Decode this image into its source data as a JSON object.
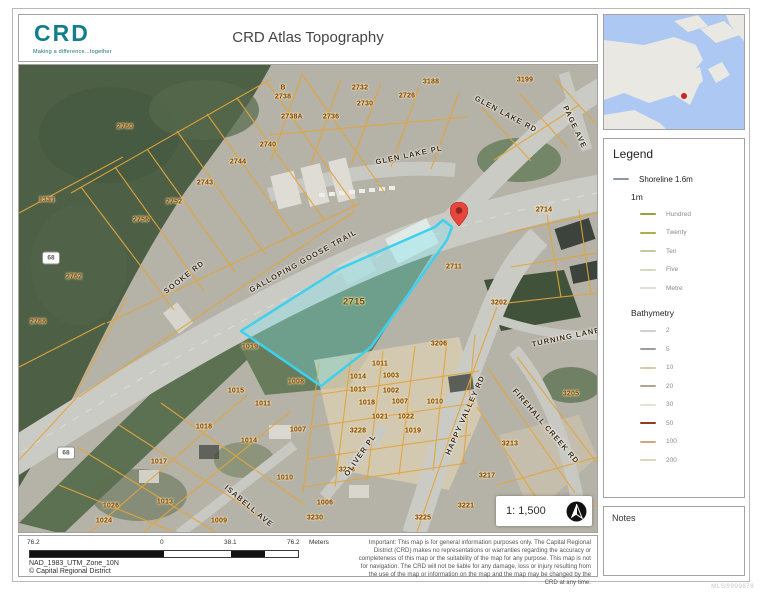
{
  "header": {
    "logo_text": "CRD",
    "logo_tagline": "Making a difference...together",
    "title": "CRD Atlas Topography"
  },
  "overview_map": {
    "water_color": "#adc8f2",
    "land_color": "#e9e8e2",
    "marker_color": "#cc2420"
  },
  "legend": {
    "title": "Legend",
    "shoreline": {
      "label": "Shoreline 1.6m",
      "color": "#8b9aa8"
    },
    "group_1m": {
      "label": "1m",
      "items": [
        {
          "label": "Hundred",
          "color": "#97a23a"
        },
        {
          "label": "Twenty",
          "color": "#a9b14b"
        },
        {
          "label": "Ten",
          "color": "#c6c8a0"
        },
        {
          "label": "Five",
          "color": "#d6d8bf"
        },
        {
          "label": "Metre",
          "color": "#e2e3d5"
        }
      ]
    },
    "group_bathymetry": {
      "label": "Bathymetry",
      "items": [
        {
          "label": "2",
          "color": "#cfcfcf"
        },
        {
          "label": "5",
          "color": "#9d9d9d"
        },
        {
          "label": "10",
          "color": "#d9c9a7"
        },
        {
          "label": "20",
          "color": "#b3a18b"
        },
        {
          "label": "30",
          "color": "#e4e0d2"
        },
        {
          "label": "50",
          "color": "#8e3b25"
        },
        {
          "label": "100",
          "color": "#d6a878"
        },
        {
          "label": "200",
          "color": "#e3d3b8"
        }
      ]
    }
  },
  "notes": {
    "title": "Notes"
  },
  "map": {
    "scale_text": "1: 1,500",
    "highlight_parcel": "2715",
    "parcel_line_color": "#e2a43c",
    "highlight_color": "#3ed0ee",
    "parcel_labels": [
      {
        "text": "2760",
        "x": 106,
        "y": 62
      },
      {
        "text": "1331",
        "x": 28,
        "y": 135
      },
      {
        "text": "2762",
        "x": 55,
        "y": 212
      },
      {
        "text": "2768",
        "x": 19,
        "y": 257
      },
      {
        "text": "2756",
        "x": 122,
        "y": 155
      },
      {
        "text": "2752",
        "x": 155,
        "y": 137
      },
      {
        "text": "2743",
        "x": 186,
        "y": 118
      },
      {
        "text": "2744",
        "x": 219,
        "y": 97
      },
      {
        "text": "2740",
        "x": 249,
        "y": 80
      },
      {
        "text": "B",
        "x": 264,
        "y": 23
      },
      {
        "text": "2738",
        "x": 264,
        "y": 32
      },
      {
        "text": "2738A",
        "x": 273,
        "y": 52
      },
      {
        "text": "2736",
        "x": 312,
        "y": 52
      },
      {
        "text": "2732",
        "x": 341,
        "y": 23
      },
      {
        "text": "2730",
        "x": 346,
        "y": 39
      },
      {
        "text": "2726",
        "x": 388,
        "y": 31
      },
      {
        "text": "3188",
        "x": 412,
        "y": 17
      },
      {
        "text": "3199",
        "x": 506,
        "y": 15
      },
      {
        "text": "2714",
        "x": 525,
        "y": 145
      },
      {
        "text": "2711",
        "x": 435,
        "y": 202
      },
      {
        "text": "2715",
        "x": 335,
        "y": 237,
        "big": true
      },
      {
        "text": "3202",
        "x": 480,
        "y": 238
      },
      {
        "text": "3206",
        "x": 420,
        "y": 279
      },
      {
        "text": "1019",
        "x": 231,
        "y": 282
      },
      {
        "text": "1008",
        "x": 277,
        "y": 317
      },
      {
        "text": "1011",
        "x": 361,
        "y": 299
      },
      {
        "text": "1015",
        "x": 217,
        "y": 326
      },
      {
        "text": "1011",
        "x": 244,
        "y": 339
      },
      {
        "text": "1014",
        "x": 339,
        "y": 312
      },
      {
        "text": "1003",
        "x": 372,
        "y": 311
      },
      {
        "text": "1013",
        "x": 339,
        "y": 325
      },
      {
        "text": "1002",
        "x": 372,
        "y": 326
      },
      {
        "text": "1018",
        "x": 348,
        "y": 338
      },
      {
        "text": "1007",
        "x": 381,
        "y": 337
      },
      {
        "text": "1010",
        "x": 416,
        "y": 337
      },
      {
        "text": "1021",
        "x": 361,
        "y": 352
      },
      {
        "text": "1022",
        "x": 387,
        "y": 352
      },
      {
        "text": "3228",
        "x": 339,
        "y": 366
      },
      {
        "text": "1019",
        "x": 394,
        "y": 366
      },
      {
        "text": "1007",
        "x": 279,
        "y": 365
      },
      {
        "text": "1014",
        "x": 230,
        "y": 376
      },
      {
        "text": "3226",
        "x": 328,
        "y": 405
      },
      {
        "text": "1010",
        "x": 266,
        "y": 413
      },
      {
        "text": "1006",
        "x": 306,
        "y": 438
      },
      {
        "text": "3230",
        "x": 296,
        "y": 453
      },
      {
        "text": "1018",
        "x": 185,
        "y": 362
      },
      {
        "text": "1017",
        "x": 140,
        "y": 397
      },
      {
        "text": "1026",
        "x": 92,
        "y": 441
      },
      {
        "text": "1024",
        "x": 85,
        "y": 456
      },
      {
        "text": "1013",
        "x": 146,
        "y": 437
      },
      {
        "text": "1009",
        "x": 200,
        "y": 456
      },
      {
        "text": "3205",
        "x": 552,
        "y": 329
      },
      {
        "text": "3213",
        "x": 491,
        "y": 379
      },
      {
        "text": "3217",
        "x": 468,
        "y": 411
      },
      {
        "text": "3221",
        "x": 447,
        "y": 441
      },
      {
        "text": "3225",
        "x": 404,
        "y": 453
      }
    ],
    "road_labels": [
      {
        "text": "SOOKE RD",
        "x": 165,
        "y": 212,
        "rot": -38
      },
      {
        "text": "GLEN LAKE PL",
        "x": 390,
        "y": 90,
        "rot": -12
      },
      {
        "text": "GLEN LAKE RD",
        "x": 487,
        "y": 49,
        "rot": 28
      },
      {
        "text": "PAGE AVE",
        "x": 556,
        "y": 62,
        "rot": 65
      },
      {
        "text": "GALLOPING GOOSE TRAIL",
        "x": 284,
        "y": 196,
        "rot": -29
      },
      {
        "text": "HAPPY VALLEY RD",
        "x": 446,
        "y": 350,
        "rot": -66
      },
      {
        "text": "OLIVER PL",
        "x": 341,
        "y": 390,
        "rot": -55
      },
      {
        "text": "ISABELL AVE",
        "x": 230,
        "y": 441,
        "rot": 40
      },
      {
        "text": "TURNING LANE",
        "x": 547,
        "y": 272,
        "rot": -12
      },
      {
        "text": "FIREHALL CREEK RD",
        "x": 527,
        "y": 361,
        "rot": 49
      }
    ],
    "shields": [
      {
        "text": "68",
        "x": 32,
        "y": 193
      },
      {
        "text": "68",
        "x": 47,
        "y": 388
      }
    ]
  },
  "footer": {
    "scalebar": {
      "left_label": "76.2",
      "zero_label": "0",
      "mid_label": "38.1",
      "right_label": "76.2",
      "unit": "Meters"
    },
    "projection": "NAD_1983_UTM_Zone_10N",
    "copyright": "© Capital Regional District",
    "disclaimer": "Important: This map is for general information purposes only. The Capital Regional District (CRD) makes no representations or warranties regarding the accuracy or completeness of this map or the suitability of the map for any purpose. This map is not for navigation. The CRD will not be liable for any damage, loss or injury resulting from the use of the map or information on the map and the map may be changed by the CRD at any time."
  },
  "watermark": "MLS®999878"
}
